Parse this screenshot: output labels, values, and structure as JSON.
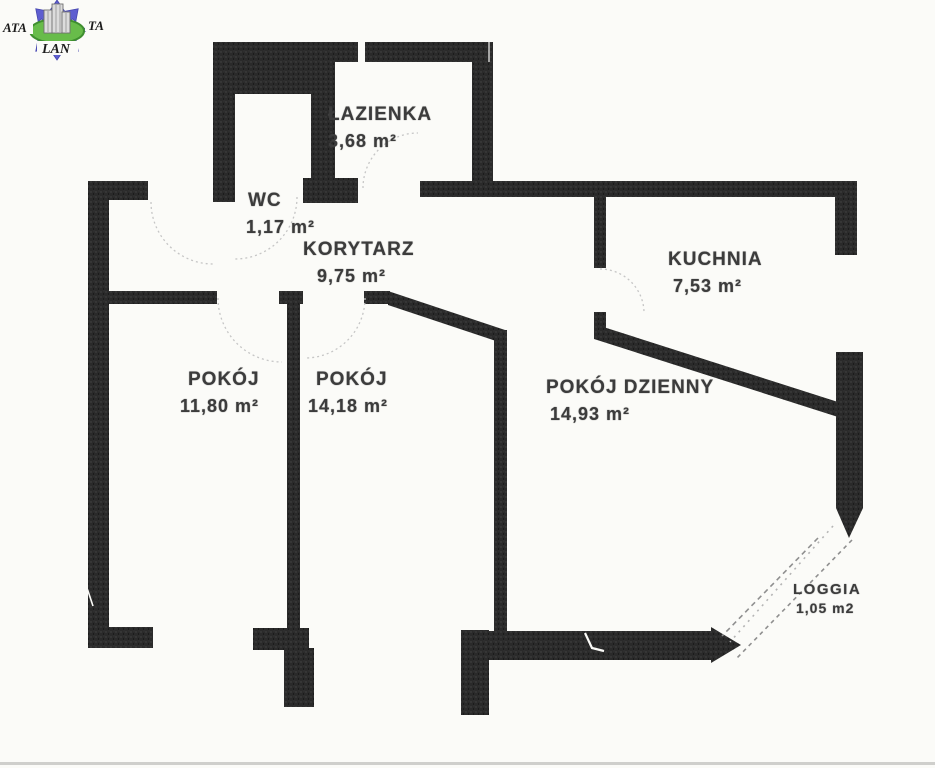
{
  "logo": {
    "text_left": "ATA",
    "text_right": "TA",
    "text_bottom": "LAN",
    "colors": {
      "arrow": "#5e5ed0",
      "ellipse": "#68bc4a",
      "ellipse_edge": "#3f8f2f",
      "building": "#dcdcdc"
    }
  },
  "plan": {
    "wall_color": "#2a2a2a",
    "background": "#fbfbf8",
    "hatch_color": "#8f8f8f"
  },
  "rooms": [
    {
      "id": "lazienka",
      "name": "ŁAZIENKA",
      "area": "3,68 m²"
    },
    {
      "id": "wc",
      "name": "WC",
      "area": "1,17 m²"
    },
    {
      "id": "korytarz",
      "name": "KORYTARZ",
      "area": "9,75 m²"
    },
    {
      "id": "kuchnia",
      "name": "KUCHNIA",
      "area": "7,53 m²"
    },
    {
      "id": "pokoj-1",
      "name": "POKÓJ",
      "area": "11,80 m²"
    },
    {
      "id": "pokoj-2",
      "name": "POKÓJ",
      "area": "14,18 m²"
    },
    {
      "id": "pokoj-dzienny",
      "name": "POKÓJ DZIENNY",
      "area": "14,93 m²"
    },
    {
      "id": "loggia",
      "name": "LOGGIA",
      "area": "1,05 m2"
    }
  ]
}
